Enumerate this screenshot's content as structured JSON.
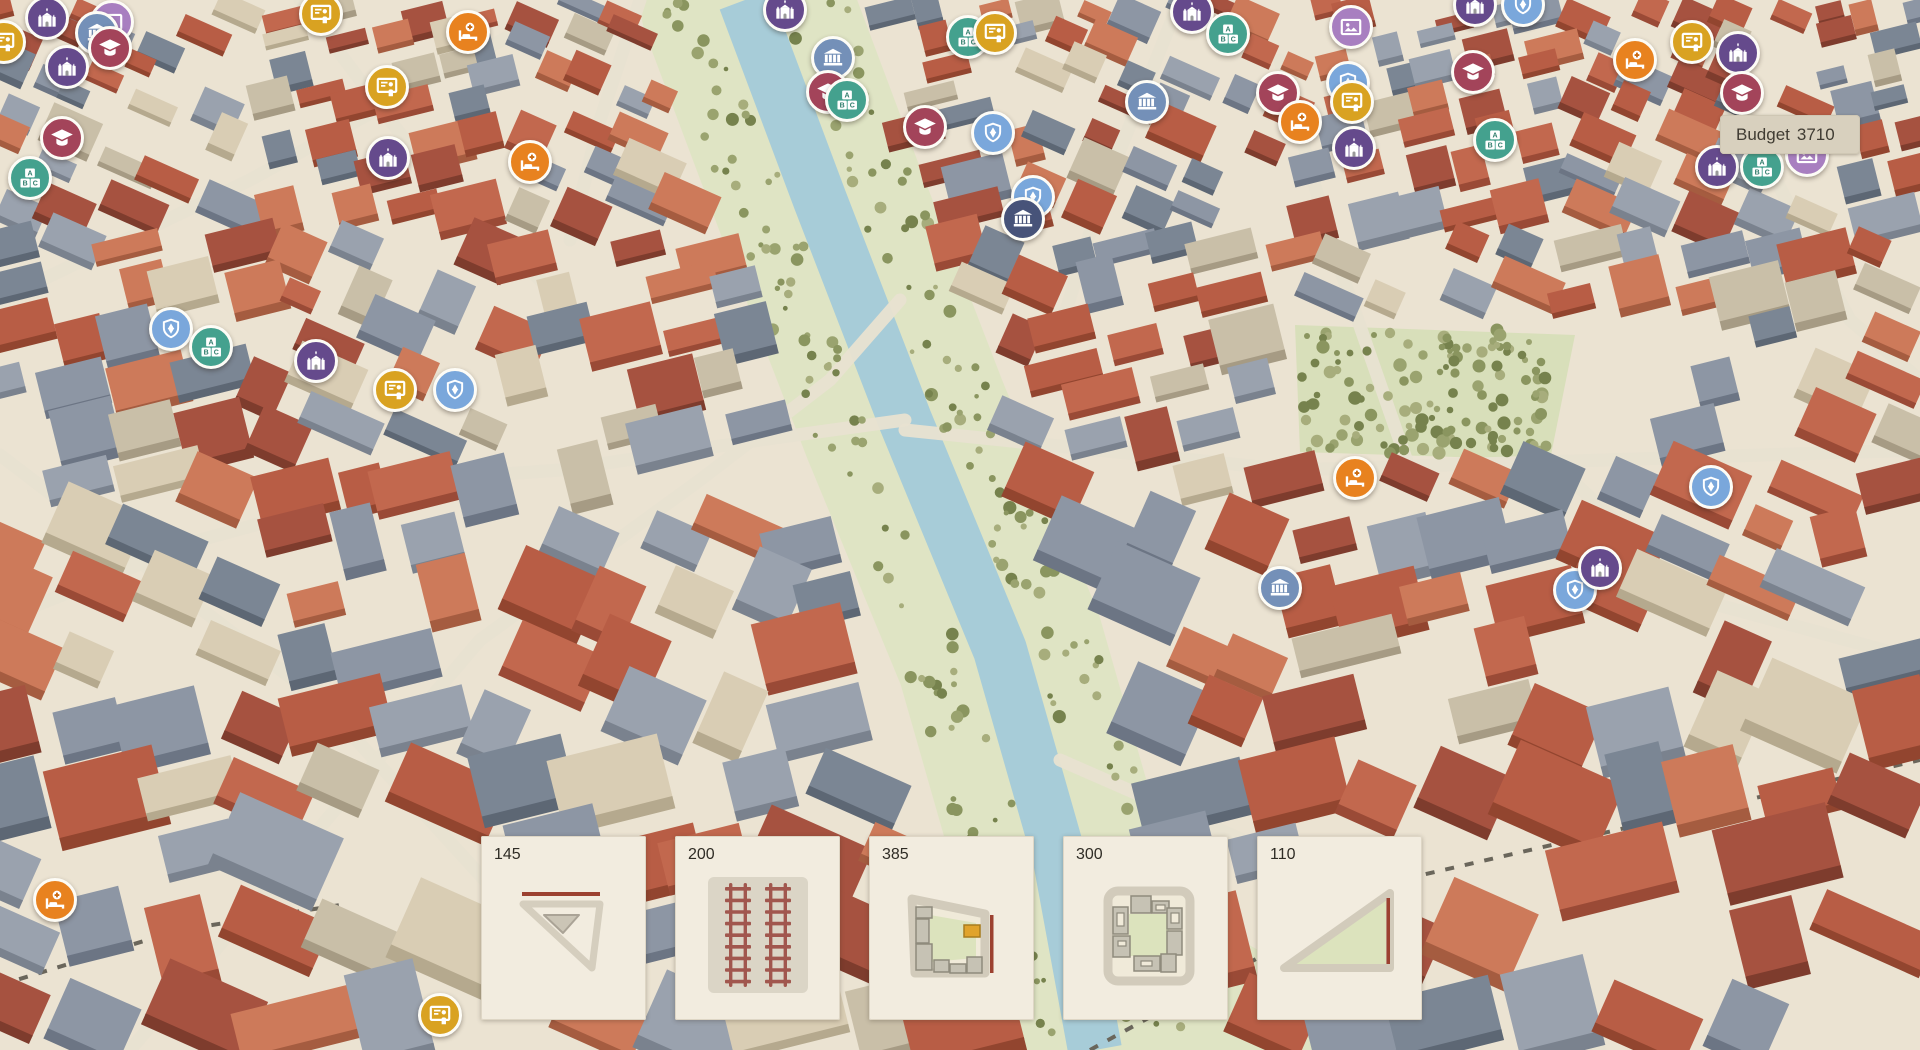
{
  "hud": {
    "budget_label": "Budget",
    "budget_value": "3710"
  },
  "toolbar": {
    "cards": [
      {
        "price": "145",
        "tile": "corner-road-triangle"
      },
      {
        "price": "200",
        "tile": "railway-tracks"
      },
      {
        "price": "385",
        "tile": "city-block-with-landmark"
      },
      {
        "price": "300",
        "tile": "courtyard-block"
      },
      {
        "price": "110",
        "tile": "park-triangle"
      }
    ]
  },
  "marker_types": {
    "church": {
      "label": "landmark building",
      "color": "#654a8c",
      "icon": "church-towers-icon"
    },
    "museum": {
      "label": "gallery",
      "color": "#a87fc0",
      "icon": "picture-frame-icon"
    },
    "bank": {
      "label": "civic building",
      "color": "#7490b8",
      "icon": "bank-columns-icon"
    },
    "bank_dark": {
      "label": "institution",
      "color": "#475379",
      "icon": "bank-columns-icon"
    },
    "education": {
      "label": "university",
      "color": "#a3445a",
      "icon": "graduation-cap-icon"
    },
    "school": {
      "label": "abc school",
      "color": "#44a18e",
      "icon": "abc-blocks-icon"
    },
    "teacher": {
      "label": "classroom",
      "color": "#d9a221",
      "icon": "teacher-board-icon"
    },
    "hospital": {
      "label": "hospital",
      "color": "#e8821f",
      "icon": "hospital-bed-icon"
    },
    "police": {
      "label": "police",
      "color": "#7aa7db",
      "icon": "shield-star-icon"
    }
  },
  "markers": [
    {
      "type": "church",
      "x": 47,
      "y": 18
    },
    {
      "type": "museum",
      "x": 112,
      "y": 22
    },
    {
      "type": "bank",
      "x": 97,
      "y": 33
    },
    {
      "type": "education",
      "x": 110,
      "y": 48
    },
    {
      "type": "church",
      "x": 67,
      "y": 67
    },
    {
      "type": "teacher",
      "x": 4,
      "y": 42
    },
    {
      "type": "education",
      "x": 62,
      "y": 138
    },
    {
      "type": "school",
      "x": 30,
      "y": 178
    },
    {
      "type": "teacher",
      "x": 321,
      "y": 14
    },
    {
      "type": "hospital",
      "x": 468,
      "y": 32
    },
    {
      "type": "teacher",
      "x": 387,
      "y": 87
    },
    {
      "type": "church",
      "x": 388,
      "y": 158
    },
    {
      "type": "hospital",
      "x": 530,
      "y": 162
    },
    {
      "type": "church",
      "x": 785,
      "y": 10
    },
    {
      "type": "bank",
      "x": 833,
      "y": 58
    },
    {
      "type": "education",
      "x": 828,
      "y": 92
    },
    {
      "type": "school",
      "x": 847,
      "y": 100
    },
    {
      "type": "school",
      "x": 968,
      "y": 37
    },
    {
      "type": "teacher",
      "x": 995,
      "y": 33
    },
    {
      "type": "education",
      "x": 925,
      "y": 127
    },
    {
      "type": "police",
      "x": 993,
      "y": 133
    },
    {
      "type": "police",
      "x": 1033,
      "y": 197
    },
    {
      "type": "bank_dark",
      "x": 1023,
      "y": 219
    },
    {
      "type": "bank",
      "x": 1147,
      "y": 102
    },
    {
      "type": "church",
      "x": 1192,
      "y": 12
    },
    {
      "type": "school",
      "x": 1228,
      "y": 34
    },
    {
      "type": "museum",
      "x": 1351,
      "y": 27
    },
    {
      "type": "education",
      "x": 1278,
      "y": 93
    },
    {
      "type": "police",
      "x": 1348,
      "y": 83
    },
    {
      "type": "teacher",
      "x": 1352,
      "y": 102
    },
    {
      "type": "hospital",
      "x": 1300,
      "y": 122
    },
    {
      "type": "church",
      "x": 1354,
      "y": 148
    },
    {
      "type": "church",
      "x": 1475,
      "y": 5
    },
    {
      "type": "police",
      "x": 1523,
      "y": 5
    },
    {
      "type": "education",
      "x": 1473,
      "y": 72
    },
    {
      "type": "school",
      "x": 1495,
      "y": 140
    },
    {
      "type": "hospital",
      "x": 1635,
      "y": 60
    },
    {
      "type": "teacher",
      "x": 1692,
      "y": 42
    },
    {
      "type": "church",
      "x": 1738,
      "y": 53
    },
    {
      "type": "education",
      "x": 1742,
      "y": 93
    },
    {
      "type": "church",
      "x": 1717,
      "y": 167
    },
    {
      "type": "school",
      "x": 1762,
      "y": 167
    },
    {
      "type": "museum",
      "x": 1807,
      "y": 155
    },
    {
      "type": "police",
      "x": 171,
      "y": 329
    },
    {
      "type": "school",
      "x": 211,
      "y": 347
    },
    {
      "type": "church",
      "x": 316,
      "y": 361
    },
    {
      "type": "teacher",
      "x": 395,
      "y": 390
    },
    {
      "type": "police",
      "x": 455,
      "y": 390
    },
    {
      "type": "hospital",
      "x": 1355,
      "y": 478
    },
    {
      "type": "bank",
      "x": 1280,
      "y": 588
    },
    {
      "type": "police",
      "x": 1575,
      "y": 590
    },
    {
      "type": "church",
      "x": 1600,
      "y": 568
    },
    {
      "type": "police",
      "x": 1711,
      "y": 487
    },
    {
      "type": "hospital",
      "x": 55,
      "y": 900
    },
    {
      "type": "teacher",
      "x": 440,
      "y": 1015
    }
  ]
}
